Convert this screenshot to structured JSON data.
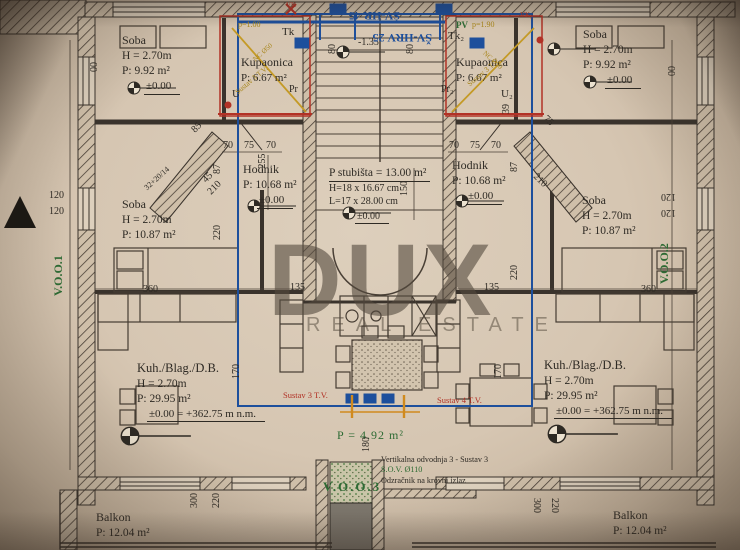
{
  "watermark": {
    "line1": "DUX",
    "line2": "REAL ESTATE"
  },
  "rooms": {
    "soba_top_left": {
      "name": "Soba",
      "height": "H = 2.70m",
      "area": "P: 9.92 m²",
      "level": "±0.00"
    },
    "soba_top_right": {
      "name": "Soba",
      "height": "H = 2.70m",
      "area": "P: 9.92 m²",
      "level": "±0.00"
    },
    "kupaonica_left": {
      "name": "Kupaonica",
      "area": "P: 6.67 m²"
    },
    "kupaonica_right": {
      "name": "Kupaonica",
      "area": "P: 6.67 m²"
    },
    "hodnik_left": {
      "name": "Hodnik",
      "area": "P: 10.68 m²",
      "level": "±0.00"
    },
    "hodnik_right": {
      "name": "Hodnik",
      "area": "P: 10.68 m²",
      "level": "±0.00"
    },
    "soba_mid_left": {
      "name": "Soba",
      "height": "H = 2.70m",
      "area": "P: 10.87 m²"
    },
    "soba_mid_right": {
      "name": "Soba",
      "height": "H = 2.70m",
      "area": "P: 10.87 m²"
    },
    "kuh_left": {
      "name": "Kuh./Blag./D.B.",
      "height": "H = 2.70m",
      "area": "P:    29.95  m²",
      "level": "±0.00 = +362.75 m n.m."
    },
    "kuh_right": {
      "name": "Kuh./Blag./D.B.",
      "height": "H = 2.70m",
      "area": "P:    29.95  m²",
      "level": "±0.00 = +362.75 m n.m."
    },
    "balkon_left": {
      "name": "Balkon",
      "area": "P: 12.04 m²"
    },
    "balkon_right": {
      "name": "Balkon",
      "area": "P: 12.04 m²"
    }
  },
  "staircase": {
    "area": "P stubišta = 13.00 m²",
    "riser": "H=18 x 16.67 cm",
    "tread": "L=17 x 28.00 cm",
    "level": "±0.00"
  },
  "shaft": {
    "area": "P = 4.92 m²",
    "code": "V.O.O.3",
    "notes": [
      "Vertikalna odvodnja 3 - Sustav 3",
      "S.O.V. Ø110",
      "Odzračnik na krovni izlaz"
    ]
  },
  "plan_labels": [
    {
      "t": "120",
      "x": 49,
      "y": 191
    },
    {
      "t": "120",
      "x": 49,
      "y": 207
    },
    {
      "t": "00",
      "x": 90,
      "y": 72,
      "r": -90
    },
    {
      "t": "120",
      "x": 676,
      "y": 201,
      "r": 180
    },
    {
      "t": "120",
      "x": 676,
      "y": 217,
      "r": 180
    },
    {
      "t": "00",
      "x": 668,
      "y": 76,
      "r": -90
    },
    {
      "t": "70",
      "x": 223,
      "y": 141
    },
    {
      "t": "75",
      "x": 244,
      "y": 141
    },
    {
      "t": "70",
      "x": 266,
      "y": 141
    },
    {
      "t": "70",
      "x": 449,
      "y": 141
    },
    {
      "t": "75",
      "x": 470,
      "y": 141
    },
    {
      "t": "70",
      "x": 491,
      "y": 141
    },
    {
      "t": "-255",
      "x": 258,
      "y": 172,
      "r": -90
    },
    {
      "t": "87",
      "x": 213,
      "y": 174,
      "r": -90
    },
    {
      "t": "87",
      "x": 510,
      "y": 172,
      "r": -90
    },
    {
      "t": "220",
      "x": 213,
      "y": 240,
      "r": -90
    },
    {
      "t": "220",
      "x": 510,
      "y": 280,
      "r": -90
    },
    {
      "t": "150",
      "x": 400,
      "y": 196,
      "r": -90
    },
    {
      "t": "85",
      "x": 190,
      "y": 128,
      "r": -45
    },
    {
      "t": "45",
      "x": 201,
      "y": 178,
      "r": -45
    },
    {
      "t": "32+20/14",
      "x": 143,
      "y": 186,
      "r": -42,
      "s": 8
    },
    {
      "t": "210",
      "x": 206,
      "y": 190,
      "r": -45
    },
    {
      "t": "75",
      "x": 548,
      "y": 114,
      "r": 45
    },
    {
      "t": "210",
      "x": 538,
      "y": 172,
      "r": 45
    },
    {
      "t": "135",
      "x": 290,
      "y": 283
    },
    {
      "t": "135",
      "x": 484,
      "y": 283
    },
    {
      "t": "360",
      "x": 143,
      "y": 285
    },
    {
      "t": "360",
      "x": 641,
      "y": 285
    },
    {
      "t": "170",
      "x": 232,
      "y": 379,
      "r": -90
    },
    {
      "t": "170",
      "x": 494,
      "y": 379,
      "r": -90
    },
    {
      "t": "300",
      "x": 190,
      "y": 508,
      "r": -90
    },
    {
      "t": "220",
      "x": 212,
      "y": 508,
      "r": -90
    },
    {
      "t": "300",
      "x": 541,
      "y": 498,
      "r": 90
    },
    {
      "t": "220",
      "x": 559,
      "y": 498,
      "r": 90
    },
    {
      "t": "-1.35",
      "x": 358,
      "y": 38
    },
    {
      "t": "80",
      "x": 328,
      "y": 54,
      "r": -90
    },
    {
      "t": "80",
      "x": 406,
      "y": 54,
      "r": -90
    },
    {
      "t": "180",
      "x": 362,
      "y": 452,
      "r": -90
    },
    {
      "t": "39",
      "x": 502,
      "y": 114,
      "r": -90
    },
    {
      "t": "Tk",
      "x": 282,
      "y": 27,
      "s": 11
    },
    {
      "t": "U",
      "x": 232,
      "y": 89,
      "s": 11
    },
    {
      "t": "Pr",
      "x": 289,
      "y": 85,
      "s": 10
    },
    {
      "t": "Tk₂",
      "x": 448,
      "y": 31,
      "s": 11
    },
    {
      "t": "U₂",
      "x": 501,
      "y": 89,
      "s": 11
    },
    {
      "t": "Pr₂",
      "x": 441,
      "y": 85,
      "s": 10
    },
    {
      "t": "PV",
      "x": 456,
      "y": 21,
      "c": "green",
      "s": 9,
      "b": 1
    },
    {
      "t": "p=1.00",
      "x": 238,
      "y": 21,
      "c": "olive",
      "s": 8
    },
    {
      "t": "p=1.90",
      "x": 472,
      "y": 21,
      "c": "olive",
      "s": 8
    },
    {
      "t": "Sustav 3 T.V.",
      "x": 234,
      "y": 90,
      "r": -40,
      "c": "olive",
      "s": 7.5
    },
    {
      "t": "Sustav 3 T.V.",
      "x": 466,
      "y": 82,
      "r": -40,
      "c": "olive",
      "s": 7.5
    },
    {
      "t": "NC Ø50",
      "x": 252,
      "y": 58,
      "r": -42,
      "c": "olive",
      "s": 7
    },
    {
      "t": "NC Ø50",
      "x": 486,
      "y": 50,
      "r": 42,
      "c": "olive",
      "s": 7
    },
    {
      "t": "Sustav 3 T.V.",
      "x": 283,
      "y": 391,
      "c": "red",
      "s": 8.5
    },
    {
      "t": "Sustav 4 T.V.",
      "x": 437,
      "y": 396,
      "c": "red",
      "s": 8.5
    },
    {
      "t": "V.O.O.1",
      "x": 52,
      "y": 296,
      "r": -90,
      "c": "green",
      "s": 12,
      "b": 1
    },
    {
      "t": "V.O.O.2",
      "x": 658,
      "y": 284,
      "r": -90,
      "c": "green",
      "s": 12,
      "b": 1
    },
    {
      "t": "ŠV-HR 45",
      "x": 400,
      "y": 22,
      "r": 180,
      "c": "blue",
      "s": 12,
      "b": 1
    },
    {
      "t": "ŠV-HRV 25",
      "x": 432,
      "y": 44,
      "r": 180,
      "c": "blue",
      "s": 12,
      "b": 1
    },
    {
      "t": "VK",
      "x": 286,
      "y": 2,
      "c": "red",
      "s": 7
    },
    {
      "t": "VK₂",
      "x": 520,
      "y": 12,
      "c": "red",
      "s": 7
    }
  ]
}
